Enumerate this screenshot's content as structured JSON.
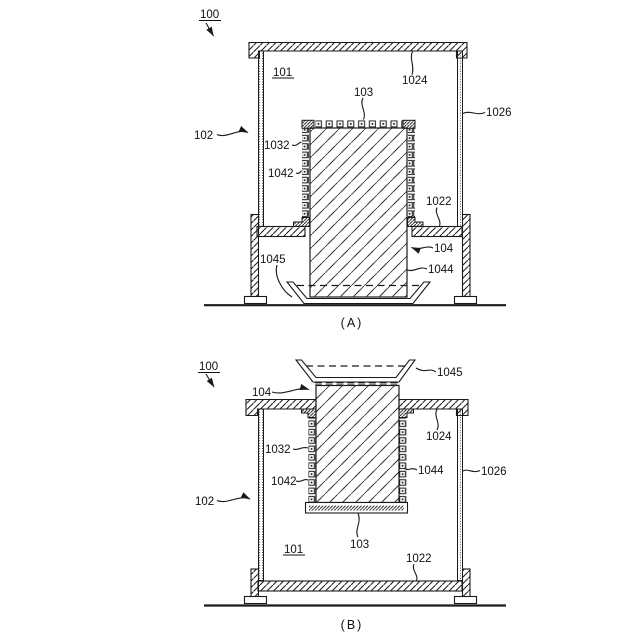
{
  "diagram": {
    "type": "patent-figure-two-views",
    "background": "#ffffff",
    "line_color": "#1a1a1a",
    "views": {
      "a": {
        "caption": "(A)"
      },
      "b": {
        "caption": "(B)"
      }
    },
    "labels": {
      "n100": "100",
      "n101": "101",
      "n102": "102",
      "n103": "103",
      "n104": "104",
      "n1022": "1022",
      "n1024": "1024",
      "n1026": "1026",
      "n1032": "1032",
      "n1042": "1042",
      "n1044": "1044",
      "n1045": "1045"
    }
  }
}
